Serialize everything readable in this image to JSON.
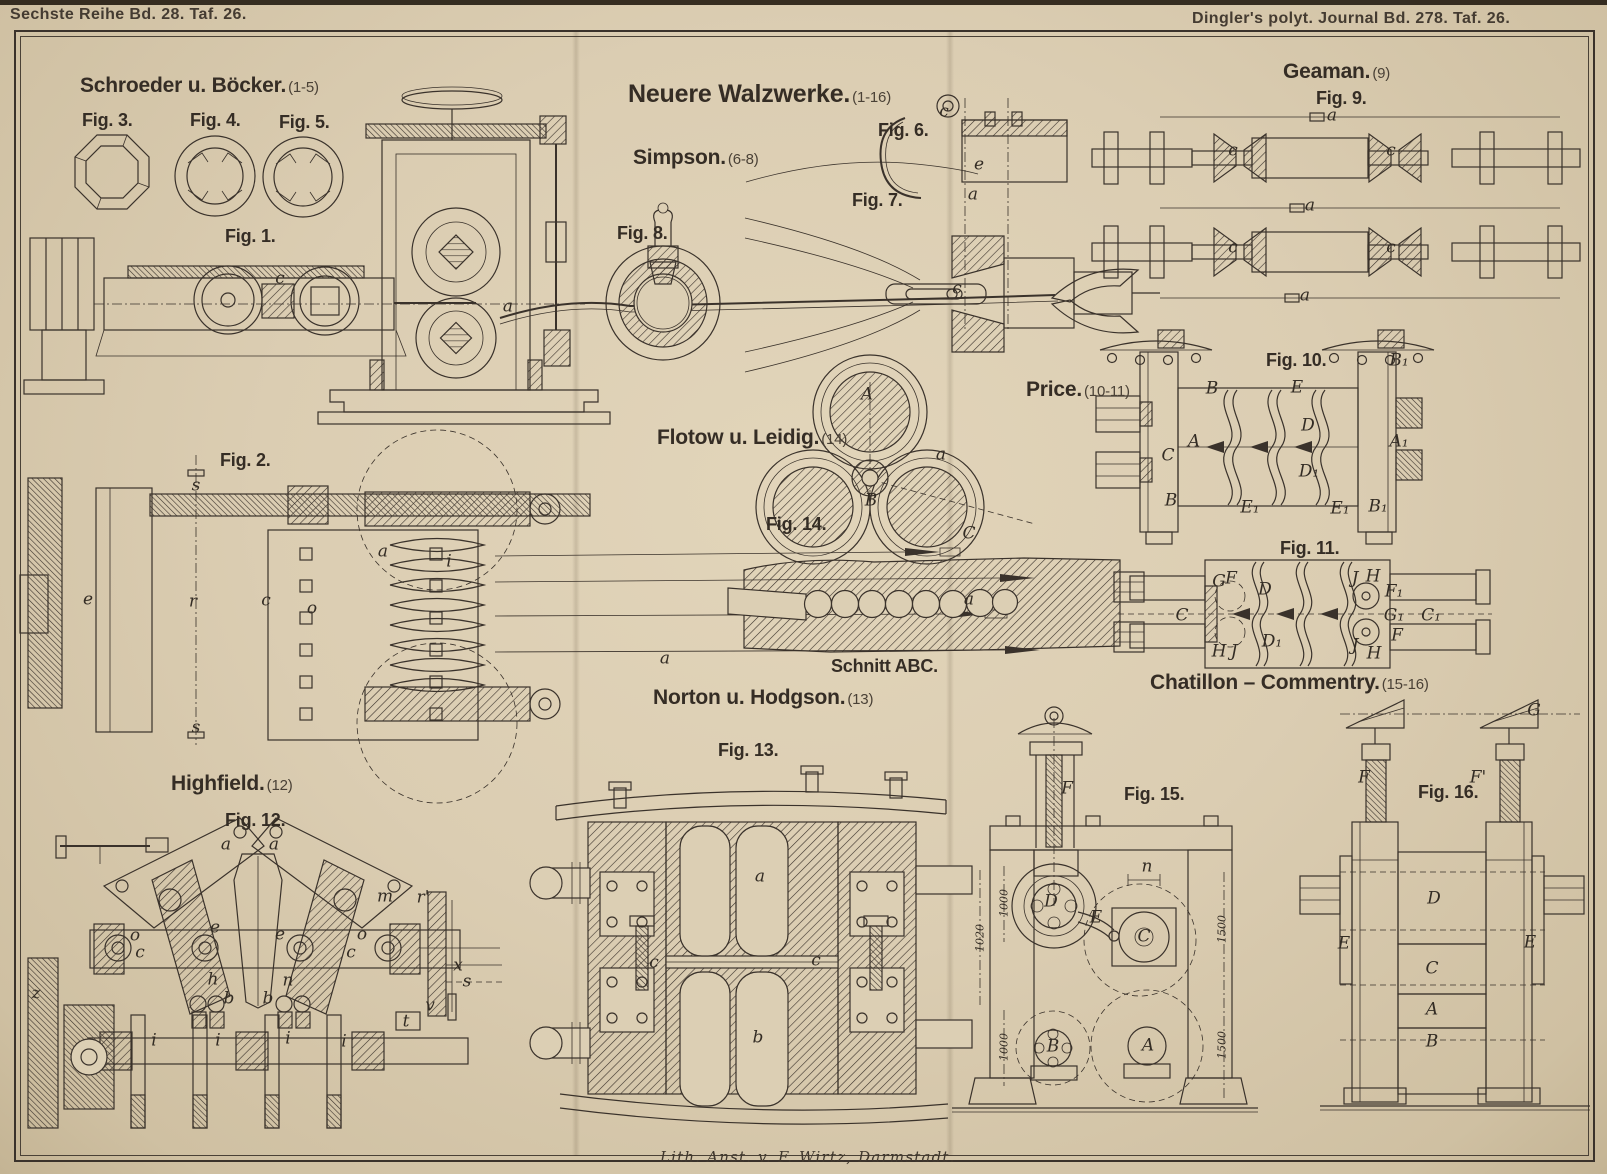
{
  "plate": {
    "header_left": "Sechste Reihe Bd. 28. Taf. 26.",
    "header_right": "Dingler's polyt. Journal Bd. 278. Taf. 26.",
    "credit": "Lith. Anst. v. F. Wirtz, Darmstadt."
  },
  "title": {
    "text": "Neuere Walzwerke.",
    "range": "(1-16)"
  },
  "sections": [
    {
      "id": "schroeder",
      "name": "Schroeder u. Böcker.",
      "range": "(1-5)"
    },
    {
      "id": "simpson",
      "name": "Simpson.",
      "range": "(6-8)"
    },
    {
      "id": "geaman",
      "name": "Geaman.",
      "range": "(9)"
    },
    {
      "id": "price",
      "name": "Price.",
      "range": "(10-11)"
    },
    {
      "id": "flotow",
      "name": "Flotow u. Leidig.",
      "range": "(14)"
    },
    {
      "id": "norton",
      "name": "Norton u. Hodgson.",
      "range": "(13)"
    },
    {
      "id": "highfield",
      "name": "Highfield.",
      "range": "(12)"
    },
    {
      "id": "chatillon",
      "name": "Chatillon – Commentry.",
      "range": "(15-16)"
    }
  ],
  "figure_titles": {
    "fig1": "Fig. 1.",
    "fig2": "Fig. 2.",
    "fig3": "Fig. 3.",
    "fig4": "Fig. 4.",
    "fig5": "Fig. 5.",
    "fig6": "Fig. 6.",
    "fig7": "Fig. 7.",
    "fig8": "Fig. 8.",
    "fig9": "Fig. 9.",
    "fig10": "Fig. 10.",
    "fig11": "Fig. 11.",
    "fig12": "Fig. 12.",
    "fig13": "Fig. 13.",
    "fig14": "Fig. 14.",
    "fig15": "Fig. 15.",
    "fig16": "Fig. 16.",
    "schnitt": "Schnitt ABC."
  },
  "part_labels": [
    {
      "fig": "fig1",
      "text": "c",
      "x": 280,
      "y": 280
    },
    {
      "fig": "fig1",
      "text": "a",
      "x": 508,
      "y": 308
    },
    {
      "fig": "fig2",
      "text": "e",
      "x": 88,
      "y": 601
    },
    {
      "fig": "fig2",
      "text": "s",
      "x": 196,
      "y": 487
    },
    {
      "fig": "fig2",
      "text": "s",
      "x": 196,
      "y": 729
    },
    {
      "fig": "fig2",
      "text": "r",
      "x": 193,
      "y": 603
    },
    {
      "fig": "fig2",
      "text": "c",
      "x": 266,
      "y": 602
    },
    {
      "fig": "fig2",
      "text": "o",
      "x": 312,
      "y": 610
    },
    {
      "fig": "fig2",
      "text": "a",
      "x": 383,
      "y": 553
    },
    {
      "fig": "fig2",
      "text": "i",
      "x": 449,
      "y": 563
    },
    {
      "fig": "fig2",
      "text": "a",
      "x": 665,
      "y": 660
    },
    {
      "fig": "fig6",
      "text": "c",
      "x": 944,
      "y": 113
    },
    {
      "fig": "fig6",
      "text": "e",
      "x": 979,
      "y": 166
    },
    {
      "fig": "fig6",
      "text": "a",
      "x": 973,
      "y": 196
    },
    {
      "fig": "fig7",
      "text": "c",
      "x": 957,
      "y": 290
    },
    {
      "fig": "fig9",
      "text": "a",
      "x": 1332,
      "y": 117
    },
    {
      "fig": "fig9",
      "text": "a",
      "x": 1310,
      "y": 207
    },
    {
      "fig": "fig9",
      "text": "a",
      "x": 1305,
      "y": 297
    },
    {
      "fig": "fig9",
      "text": "c",
      "x": 1233,
      "y": 152
    },
    {
      "fig": "fig9",
      "text": "c",
      "x": 1391,
      "y": 152
    },
    {
      "fig": "fig9",
      "text": "c",
      "x": 1233,
      "y": 249
    },
    {
      "fig": "fig9",
      "text": "c",
      "x": 1391,
      "y": 249
    },
    {
      "fig": "fig10",
      "text": "B",
      "x": 1212,
      "y": 390
    },
    {
      "fig": "fig10",
      "text": "E",
      "x": 1297,
      "y": 389
    },
    {
      "fig": "fig10",
      "text": "A",
      "x": 1194,
      "y": 443
    },
    {
      "fig": "fig10",
      "text": "C",
      "x": 1168,
      "y": 457
    },
    {
      "fig": "fig10",
      "text": "D",
      "x": 1308,
      "y": 427
    },
    {
      "fig": "fig10",
      "text": "D₁",
      "x": 1309,
      "y": 473
    },
    {
      "fig": "fig10",
      "text": "B",
      "x": 1171,
      "y": 502
    },
    {
      "fig": "fig10",
      "text": "E₁",
      "x": 1250,
      "y": 509
    },
    {
      "fig": "fig10",
      "text": "E₁",
      "x": 1340,
      "y": 510
    },
    {
      "fig": "fig10",
      "text": "B₁",
      "x": 1378,
      "y": 508
    },
    {
      "fig": "fig10",
      "text": "A₁",
      "x": 1399,
      "y": 443
    },
    {
      "fig": "fig10",
      "text": "B₁",
      "x": 1399,
      "y": 362
    },
    {
      "fig": "fig11",
      "text": "G",
      "x": 1219,
      "y": 583
    },
    {
      "fig": "fig11",
      "text": "F",
      "x": 1231,
      "y": 580
    },
    {
      "fig": "fig11",
      "text": "D",
      "x": 1265,
      "y": 591
    },
    {
      "fig": "fig11",
      "text": "J",
      "x": 1355,
      "y": 580
    },
    {
      "fig": "fig11",
      "text": "H",
      "x": 1373,
      "y": 578
    },
    {
      "fig": "fig11",
      "text": "F₁",
      "x": 1394,
      "y": 593
    },
    {
      "fig": "fig11",
      "text": "C",
      "x": 1182,
      "y": 617
    },
    {
      "fig": "fig11",
      "text": "G₁",
      "x": 1394,
      "y": 617
    },
    {
      "fig": "fig11",
      "text": "C₁",
      "x": 1431,
      "y": 617
    },
    {
      "fig": "fig11",
      "text": "D₁",
      "x": 1272,
      "y": 643
    },
    {
      "fig": "fig11",
      "text": "F",
      "x": 1397,
      "y": 637
    },
    {
      "fig": "fig11",
      "text": "H",
      "x": 1219,
      "y": 653
    },
    {
      "fig": "fig11",
      "text": "J",
      "x": 1234,
      "y": 653
    },
    {
      "fig": "fig11",
      "text": "J",
      "x": 1355,
      "y": 647
    },
    {
      "fig": "fig11",
      "text": "H",
      "x": 1374,
      "y": 655
    },
    {
      "fig": "fig12",
      "text": "a",
      "x": 226,
      "y": 846
    },
    {
      "fig": "fig12",
      "text": "a",
      "x": 274,
      "y": 846
    },
    {
      "fig": "fig12",
      "text": "m",
      "x": 385,
      "y": 898
    },
    {
      "fig": "fig12",
      "text": "r'",
      "x": 423,
      "y": 899
    },
    {
      "fig": "fig12",
      "text": "o",
      "x": 135,
      "y": 937
    },
    {
      "fig": "fig12",
      "text": "e",
      "x": 215,
      "y": 929
    },
    {
      "fig": "fig12",
      "text": "e",
      "x": 280,
      "y": 936
    },
    {
      "fig": "fig12",
      "text": "o",
      "x": 362,
      "y": 936
    },
    {
      "fig": "fig12",
      "text": "c",
      "x": 140,
      "y": 954
    },
    {
      "fig": "fig12",
      "text": "c",
      "x": 351,
      "y": 954
    },
    {
      "fig": "fig12",
      "text": "h",
      "x": 213,
      "y": 981
    },
    {
      "fig": "fig12",
      "text": "n",
      "x": 288,
      "y": 982
    },
    {
      "fig": "fig12",
      "text": "b",
      "x": 229,
      "y": 1000
    },
    {
      "fig": "fig12",
      "text": "b",
      "x": 268,
      "y": 1000
    },
    {
      "fig": "fig12",
      "text": "x",
      "x": 458,
      "y": 967
    },
    {
      "fig": "fig12",
      "text": "s",
      "x": 467,
      "y": 983
    },
    {
      "fig": "fig12",
      "text": "v",
      "x": 430,
      "y": 1007
    },
    {
      "fig": "fig12",
      "text": "t",
      "x": 406,
      "y": 1023
    },
    {
      "fig": "fig12",
      "text": "i",
      "x": 154,
      "y": 1042
    },
    {
      "fig": "fig12",
      "text": "i",
      "x": 218,
      "y": 1042
    },
    {
      "fig": "fig12",
      "text": "i",
      "x": 288,
      "y": 1040
    },
    {
      "fig": "fig12",
      "text": "i",
      "x": 344,
      "y": 1043
    },
    {
      "fig": "fig12",
      "text": "z",
      "x": 36,
      "y": 995
    },
    {
      "fig": "fig13",
      "text": "a",
      "x": 760,
      "y": 878
    },
    {
      "fig": "fig13",
      "text": "b",
      "x": 758,
      "y": 1039
    },
    {
      "fig": "fig13",
      "text": "c",
      "x": 654,
      "y": 964
    },
    {
      "fig": "fig13",
      "text": "c",
      "x": 816,
      "y": 962
    },
    {
      "fig": "fig14",
      "text": "A",
      "x": 867,
      "y": 396
    },
    {
      "fig": "fig14",
      "text": "a",
      "x": 941,
      "y": 456
    },
    {
      "fig": "fig14",
      "text": "B",
      "x": 871,
      "y": 502
    },
    {
      "fig": "fig14",
      "text": "C",
      "x": 969,
      "y": 535
    },
    {
      "fig": "schnitt",
      "text": "a",
      "x": 969,
      "y": 601
    },
    {
      "fig": "fig15",
      "text": "F",
      "x": 1067,
      "y": 790
    },
    {
      "fig": "fig15",
      "text": "n",
      "x": 1147,
      "y": 868
    },
    {
      "fig": "fig15",
      "text": "D",
      "x": 1051,
      "y": 903
    },
    {
      "fig": "fig15",
      "text": "E",
      "x": 1096,
      "y": 919
    },
    {
      "fig": "fig15",
      "text": "C",
      "x": 1144,
      "y": 938
    },
    {
      "fig": "fig15",
      "text": "B",
      "x": 1053,
      "y": 1048
    },
    {
      "fig": "fig15",
      "text": "A",
      "x": 1148,
      "y": 1047
    },
    {
      "fig": "fig15",
      "text": "1000",
      "x": 1004,
      "y": 903,
      "rot": true
    },
    {
      "fig": "fig15",
      "text": "1020",
      "x": 980,
      "y": 938,
      "rot": true
    },
    {
      "fig": "fig15",
      "text": "1000",
      "x": 1004,
      "y": 1047,
      "rot": true
    },
    {
      "fig": "fig15",
      "text": "1500",
      "x": 1222,
      "y": 929,
      "rot": true
    },
    {
      "fig": "fig15",
      "text": "1500",
      "x": 1222,
      "y": 1045,
      "rot": true
    },
    {
      "fig": "fig16",
      "text": "G",
      "x": 1534,
      "y": 712
    },
    {
      "fig": "fig16",
      "text": "F",
      "x": 1364,
      "y": 779
    },
    {
      "fig": "fig16",
      "text": "F'",
      "x": 1478,
      "y": 779
    },
    {
      "fig": "fig16",
      "text": "D",
      "x": 1434,
      "y": 900
    },
    {
      "fig": "fig16",
      "text": "E",
      "x": 1344,
      "y": 945
    },
    {
      "fig": "fig16",
      "text": "E",
      "x": 1530,
      "y": 944
    },
    {
      "fig": "fig16",
      "text": "C",
      "x": 1432,
      "y": 970
    },
    {
      "fig": "fig16",
      "text": "A",
      "x": 1432,
      "y": 1011
    },
    {
      "fig": "fig16",
      "text": "B",
      "x": 1432,
      "y": 1043
    }
  ],
  "colors": {
    "paper": "#dbcdb2",
    "ink": "#3a322b"
  }
}
